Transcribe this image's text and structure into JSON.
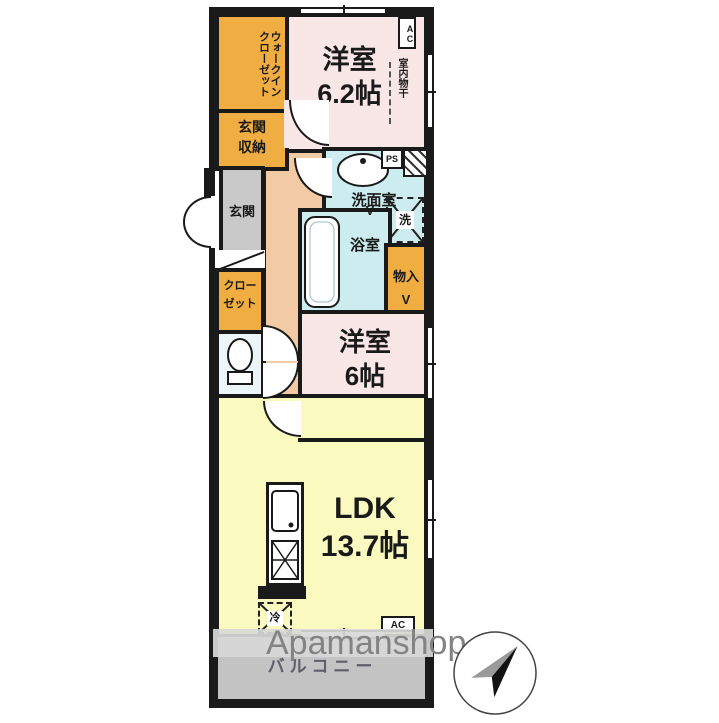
{
  "rooms": {
    "wic": {
      "l1": "ウォークイン",
      "l2": "クローゼット"
    },
    "entStorage": {
      "l1": "玄関",
      "l2": "収納"
    },
    "bedroom1": {
      "name": "洋室",
      "size": "6.2帖"
    },
    "drying": "室内物干",
    "washroom": "洗面室",
    "bathroom": "浴室",
    "storage": "物入",
    "closet": {
      "l1": "クロー",
      "l2": "ゼット"
    },
    "entrance": "玄関",
    "bedroom2": {
      "name": "洋室",
      "size": "6帖"
    },
    "ldk": {
      "name": "LDK",
      "size": "13.7帖"
    },
    "balcony": "バルコニー"
  },
  "marks": {
    "ps": "PS",
    "acTop": "AC",
    "acBottom": "AC",
    "washer": "洗",
    "fridge": "冷",
    "foldV": "V"
  },
  "watermark": "Apamanshop",
  "colors": {
    "orange": "#f0ad42",
    "pink": "#f9e7e7",
    "corridor_peach": "#f2cba6",
    "wet_cyan": "#cdecf0",
    "toilet_blue": "#ecf5f7",
    "ldk_yellow": "#fafac0",
    "entrance_gray": "#c9c9c9",
    "balcony_gray": "#c3c3c3",
    "wall_black": "#1a1a1a",
    "watermark_gray": "#838383"
  }
}
